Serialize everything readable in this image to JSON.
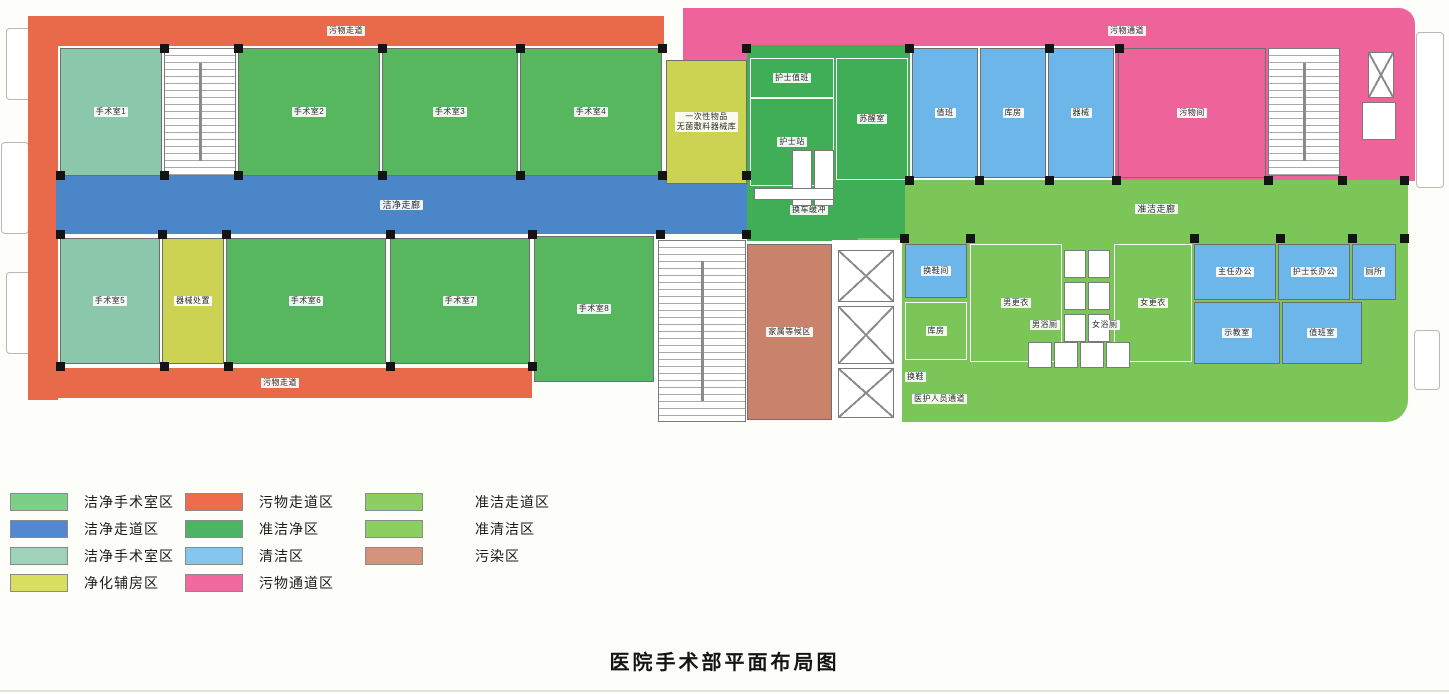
{
  "title": "医院手术部平面布局图",
  "palette": {
    "orGreen": "#56b75e",
    "teal": "#8bc7ab",
    "blue": "#4a86c8",
    "ltBlue": "#6db6ea",
    "yellow": "#ccd352",
    "orange": "#e9694b",
    "midGreen": "#3fae57",
    "ltGreen": "#7cc558",
    "pink": "#ef639b",
    "salmon": "#c9836b"
  },
  "legend": {
    "columns": [
      [
        {
          "label": "洁净手术室区",
          "color": "#7ccf84"
        },
        {
          "label": "洁净走道区",
          "color": "#5288cf"
        },
        {
          "label": "洁净手术室区",
          "color": "#9ed2b9"
        },
        {
          "label": "净化辅房区",
          "color": "#d8de5e"
        }
      ],
      [
        {
          "label": "污物走道区",
          "color": "#ee6b4e"
        },
        {
          "label": "准洁净区",
          "color": "#4db463"
        },
        {
          "label": "清洁区",
          "color": "#85c6ee"
        },
        {
          "label": "污物通道区",
          "color": "#f468a0"
        }
      ],
      [
        {
          "label": "准洁走道区",
          "color": "#8bcf63"
        },
        {
          "label": "准清洁区",
          "color": "#8bcf63"
        },
        {
          "label": "污染区",
          "color": "#d6937b"
        }
      ]
    ]
  },
  "floorplan": {
    "outlines": [
      {
        "x": 6,
        "y": 28,
        "w": 26,
        "h": 72
      },
      {
        "x": 1,
        "y": 142,
        "w": 28,
        "h": 92
      },
      {
        "x": 6,
        "y": 272,
        "w": 26,
        "h": 82
      },
      {
        "x": 1416,
        "y": 32,
        "w": 28,
        "h": 156
      },
      {
        "x": 1414,
        "y": 330,
        "w": 26,
        "h": 60
      }
    ],
    "zones": [
      {
        "id": "waste-corridor-top",
        "label": "污物走道",
        "x": 28,
        "y": 16,
        "w": 636,
        "h": 30,
        "fill": "orange",
        "r": "14px 0 0 0"
      },
      {
        "id": "waste-corridor-left",
        "x": 28,
        "y": 16,
        "w": 30,
        "h": 384,
        "fill": "orange"
      },
      {
        "id": "waste-corridor-bottom",
        "label": "污物走道",
        "x": 28,
        "y": 368,
        "w": 504,
        "h": 30,
        "fill": "orange",
        "r": "0 0 0 10px"
      },
      {
        "id": "waste-passage-topcenter",
        "x": 683,
        "y": 8,
        "w": 64,
        "h": 54,
        "fill": "pink"
      },
      {
        "id": "waste-passage-top",
        "label": "污物通道",
        "lx": 1108,
        "ly": 26,
        "x": 747,
        "y": 8,
        "w": 668,
        "h": 38,
        "fill": "pink",
        "r": "0 16px 0 0"
      },
      {
        "id": "waste-passage-right",
        "x": 1115,
        "y": 45,
        "w": 300,
        "h": 136,
        "fill": "pink"
      },
      {
        "id": "clean-corridor",
        "label": "洁净走廊",
        "big": true,
        "x": 56,
        "y": 176,
        "w": 691,
        "h": 58,
        "fill": "blue"
      },
      {
        "id": "quasi-clean-block",
        "label": "换车缓冲",
        "lx": 790,
        "ly": 205,
        "x": 747,
        "y": 45,
        "w": 163,
        "h": 196,
        "fill": "midGreen"
      },
      {
        "id": "quasi-clean-corridor",
        "label": "准洁走廊",
        "big": true,
        "x": 905,
        "y": 180,
        "w": 503,
        "h": 58,
        "fill": "ltGreen"
      },
      {
        "id": "staff-passage",
        "label": "医护人员通道",
        "lx": 912,
        "ly": 394,
        "x": 858,
        "y": 238,
        "w": 550,
        "h": 184,
        "fill": "ltGreen",
        "r": "0 0 22px 0"
      },
      {
        "id": "elevator-bank-bg",
        "x": 832,
        "y": 240,
        "w": 70,
        "h": 182,
        "fill": "white"
      }
    ],
    "rooms": [
      {
        "id": "or-1",
        "label": "手术室1",
        "x": 60,
        "y": 48,
        "w": 102,
        "h": 128,
        "fill": "teal"
      },
      {
        "id": "or-2",
        "label": "手术室2",
        "x": 238,
        "y": 48,
        "w": 142,
        "h": 128,
        "fill": "orGreen"
      },
      {
        "id": "or-3",
        "label": "手术室3",
        "x": 382,
        "y": 48,
        "w": 136,
        "h": 128,
        "fill": "orGreen"
      },
      {
        "id": "or-4",
        "label": "手术室4",
        "x": 520,
        "y": 48,
        "w": 142,
        "h": 128,
        "fill": "orGreen"
      },
      {
        "id": "supply-room",
        "label": "一次性物品\n无菌敷料器械库",
        "x": 666,
        "y": 60,
        "w": 81,
        "h": 124,
        "fill": "yellow"
      },
      {
        "id": "or-5",
        "label": "手术室5",
        "x": 60,
        "y": 238,
        "w": 100,
        "h": 126,
        "fill": "teal"
      },
      {
        "id": "instrument-prep",
        "label": "器械处置",
        "x": 162,
        "y": 238,
        "w": 62,
        "h": 126,
        "fill": "yellow"
      },
      {
        "id": "or-6",
        "label": "手术室6",
        "x": 226,
        "y": 238,
        "w": 160,
        "h": 126,
        "fill": "orGreen"
      },
      {
        "id": "or-7",
        "label": "手术室7",
        "x": 390,
        "y": 238,
        "w": 140,
        "h": 126,
        "fill": "orGreen"
      },
      {
        "id": "or-8",
        "label": "手术室8",
        "x": 534,
        "y": 236,
        "w": 120,
        "h": 146,
        "fill": "orGreen"
      },
      {
        "id": "nurse-duty",
        "label": "护士值班",
        "wall": "light",
        "x": 750,
        "y": 58,
        "w": 84,
        "h": 40,
        "fill": "midGreen"
      },
      {
        "id": "nurse-station",
        "label": "护士站",
        "wall": "light",
        "x": 750,
        "y": 98,
        "w": 84,
        "h": 88,
        "fill": "midGreen"
      },
      {
        "id": "recovery-room",
        "label": "苏醒室",
        "wall": "light",
        "x": 836,
        "y": 58,
        "w": 72,
        "h": 122,
        "fill": "midGreen"
      },
      {
        "id": "clean-room-1",
        "label": "值班",
        "x": 912,
        "y": 48,
        "w": 66,
        "h": 130,
        "fill": "ltBlue"
      },
      {
        "id": "clean-room-2",
        "label": "库房",
        "x": 980,
        "y": 48,
        "w": 66,
        "h": 130,
        "fill": "ltBlue"
      },
      {
        "id": "clean-room-3",
        "label": "器械",
        "x": 1048,
        "y": 48,
        "w": 66,
        "h": 130,
        "fill": "ltBlue"
      },
      {
        "id": "waste-room",
        "label": "污物间",
        "x": 1118,
        "y": 48,
        "w": 148,
        "h": 130,
        "fill": "pink"
      },
      {
        "id": "family-waiting",
        "label": "家属等候区",
        "x": 747,
        "y": 244,
        "w": 85,
        "h": 176,
        "fill": "salmon"
      },
      {
        "id": "shoe-change-room",
        "label": "换鞋间",
        "x": 905,
        "y": 244,
        "w": 62,
        "h": 54,
        "fill": "ltBlue"
      },
      {
        "id": "store-room",
        "label": "库房",
        "wall": "light",
        "x": 905,
        "y": 302,
        "w": 62,
        "h": 58,
        "fill": "ltGreen"
      },
      {
        "id": "men-changing",
        "label": "男更衣",
        "wall": "light",
        "x": 970,
        "y": 244,
        "w": 92,
        "h": 118,
        "fill": "ltGreen"
      },
      {
        "id": "women-changing",
        "label": "女更衣",
        "wall": "light",
        "x": 1114,
        "y": 244,
        "w": 78,
        "h": 118,
        "fill": "ltGreen"
      },
      {
        "id": "office-director",
        "label": "主任办公",
        "x": 1194,
        "y": 244,
        "w": 82,
        "h": 56,
        "fill": "ltBlue"
      },
      {
        "id": "office-head-nurse",
        "label": "护士长办公",
        "x": 1278,
        "y": 244,
        "w": 72,
        "h": 56,
        "fill": "ltBlue"
      },
      {
        "id": "toilet",
        "label": "厕所",
        "x": 1352,
        "y": 244,
        "w": 44,
        "h": 56,
        "fill": "ltBlue"
      },
      {
        "id": "demo-room",
        "label": "示教室",
        "x": 1194,
        "y": 302,
        "w": 86,
        "h": 62,
        "fill": "ltBlue"
      },
      {
        "id": "duty-room",
        "label": "值班室",
        "x": 1282,
        "y": 302,
        "w": 80,
        "h": 62,
        "fill": "ltBlue"
      }
    ],
    "features": [
      {
        "type": "stair",
        "x": 164,
        "y": 48,
        "w": 72,
        "h": 128
      },
      {
        "type": "stair",
        "x": 658,
        "y": 240,
        "w": 88,
        "h": 182
      },
      {
        "type": "stair",
        "x": 1268,
        "y": 48,
        "w": 72,
        "h": 128
      },
      {
        "type": "elev",
        "x": 1368,
        "y": 52,
        "w": 26,
        "h": 46
      },
      {
        "type": "box",
        "x": 1362,
        "y": 102,
        "w": 34,
        "h": 38
      },
      {
        "type": "elev",
        "x": 838,
        "y": 250,
        "w": 56,
        "h": 52
      },
      {
        "type": "elev",
        "x": 838,
        "y": 306,
        "w": 56,
        "h": 58
      },
      {
        "type": "elev",
        "x": 838,
        "y": 368,
        "w": 56,
        "h": 50
      },
      {
        "type": "box",
        "x": 792,
        "y": 150,
        "w": 20,
        "h": 56
      },
      {
        "type": "box",
        "x": 814,
        "y": 150,
        "w": 20,
        "h": 56
      },
      {
        "type": "box",
        "x": 754,
        "y": 188,
        "w": 80,
        "h": 12
      },
      {
        "type": "box",
        "x": 1064,
        "y": 250,
        "w": 22,
        "h": 28
      },
      {
        "type": "box",
        "x": 1088,
        "y": 250,
        "w": 22,
        "h": 28
      },
      {
        "type": "box",
        "x": 1064,
        "y": 282,
        "w": 22,
        "h": 28
      },
      {
        "type": "box",
        "x": 1088,
        "y": 282,
        "w": 22,
        "h": 28
      },
      {
        "type": "box",
        "x": 1064,
        "y": 314,
        "w": 22,
        "h": 28
      },
      {
        "type": "box",
        "x": 1088,
        "y": 314,
        "w": 22,
        "h": 28
      },
      {
        "type": "box",
        "x": 1028,
        "y": 342,
        "w": 24,
        "h": 26
      },
      {
        "type": "box",
        "x": 1054,
        "y": 342,
        "w": 24,
        "h": 26
      },
      {
        "type": "box",
        "x": 1080,
        "y": 342,
        "w": 24,
        "h": 26
      },
      {
        "type": "box",
        "x": 1106,
        "y": 342,
        "w": 24,
        "h": 26
      }
    ],
    "chips": [
      {
        "label": "换鞋",
        "x": 905,
        "y": 372
      },
      {
        "label": "男浴厕",
        "x": 1030,
        "y": 320
      },
      {
        "label": "女浴厕",
        "x": 1090,
        "y": 320
      }
    ],
    "posts": [
      [
        56,
        171
      ],
      [
        160,
        171
      ],
      [
        234,
        171
      ],
      [
        378,
        171
      ],
      [
        516,
        171
      ],
      [
        658,
        171
      ],
      [
        742,
        171
      ],
      [
        56,
        230
      ],
      [
        158,
        230
      ],
      [
        222,
        230
      ],
      [
        386,
        230
      ],
      [
        528,
        230
      ],
      [
        656,
        230
      ],
      [
        742,
        230
      ],
      [
        160,
        44
      ],
      [
        234,
        44
      ],
      [
        378,
        44
      ],
      [
        516,
        44
      ],
      [
        658,
        44
      ],
      [
        742,
        44
      ],
      [
        905,
        44
      ],
      [
        1045,
        44
      ],
      [
        1115,
        44
      ],
      [
        905,
        176
      ],
      [
        975,
        176
      ],
      [
        1045,
        176
      ],
      [
        1112,
        176
      ],
      [
        1264,
        176
      ],
      [
        1338,
        176
      ],
      [
        1400,
        176
      ],
      [
        900,
        234
      ],
      [
        966,
        234
      ],
      [
        1190,
        234
      ],
      [
        1276,
        234
      ],
      [
        1348,
        234
      ],
      [
        1400,
        234
      ],
      [
        56,
        362
      ],
      [
        160,
        362
      ],
      [
        224,
        362
      ],
      [
        386,
        362
      ],
      [
        528,
        362
      ]
    ]
  }
}
